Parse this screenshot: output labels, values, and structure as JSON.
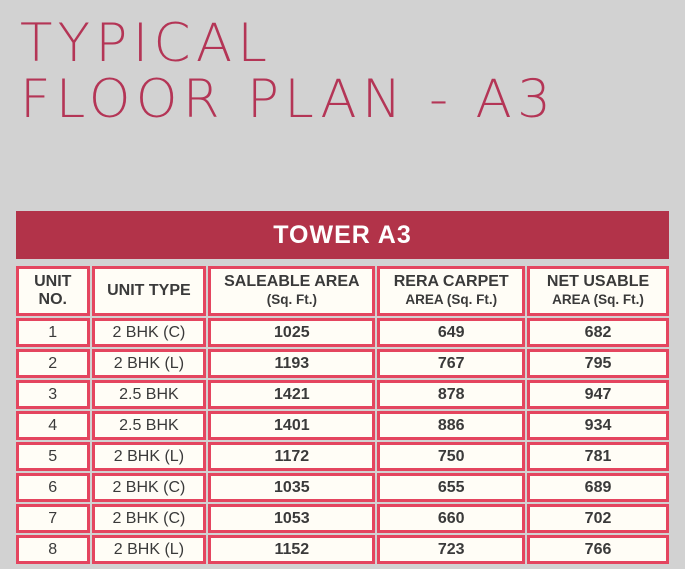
{
  "page": {
    "title_line1": "TYPICAL",
    "title_line2": "FLOOR PLAN - A3"
  },
  "table": {
    "title": "TOWER A3",
    "columns": [
      {
        "line1": "UNIT",
        "line2": "NO."
      },
      {
        "line1": "UNIT TYPE",
        "line2": ""
      },
      {
        "line1": "SALEABLE AREA",
        "line2": "(Sq. Ft.)"
      },
      {
        "line1": "RERA CARPET",
        "line2": "AREA (Sq. Ft.)"
      },
      {
        "line1": "NET USABLE",
        "line2": "AREA (Sq. Ft.)"
      }
    ],
    "column_keys": [
      "unit-no",
      "unit-type",
      "saleable-area",
      "rera-carpet-area",
      "net-usable-area"
    ],
    "rows": [
      [
        "1",
        "2 BHK (C)",
        "1025",
        "649",
        "682"
      ],
      [
        "2",
        "2 BHK (L)",
        "1193",
        "767",
        "795"
      ],
      [
        "3",
        "2.5 BHK",
        "1421",
        "878",
        "947"
      ],
      [
        "4",
        "2.5 BHK",
        "1401",
        "886",
        "934"
      ],
      [
        "5",
        "2 BHK (L)",
        "1172",
        "750",
        "781"
      ],
      [
        "6",
        "2 BHK (C)",
        "1035",
        "655",
        "689"
      ],
      [
        "7",
        "2 BHK (C)",
        "1053",
        "660",
        "702"
      ],
      [
        "8",
        "2 BHK (L)",
        "1152",
        "723",
        "766"
      ]
    ]
  },
  "colors": {
    "page_bg": "#d2d2d2",
    "title_color": "#b43556",
    "bar_bg": "#b23349",
    "bar_text": "#ffffff",
    "border_pink": "#e4455f",
    "cell_bg": "#fffdf6",
    "text_dark": "#3a3a3a"
  }
}
